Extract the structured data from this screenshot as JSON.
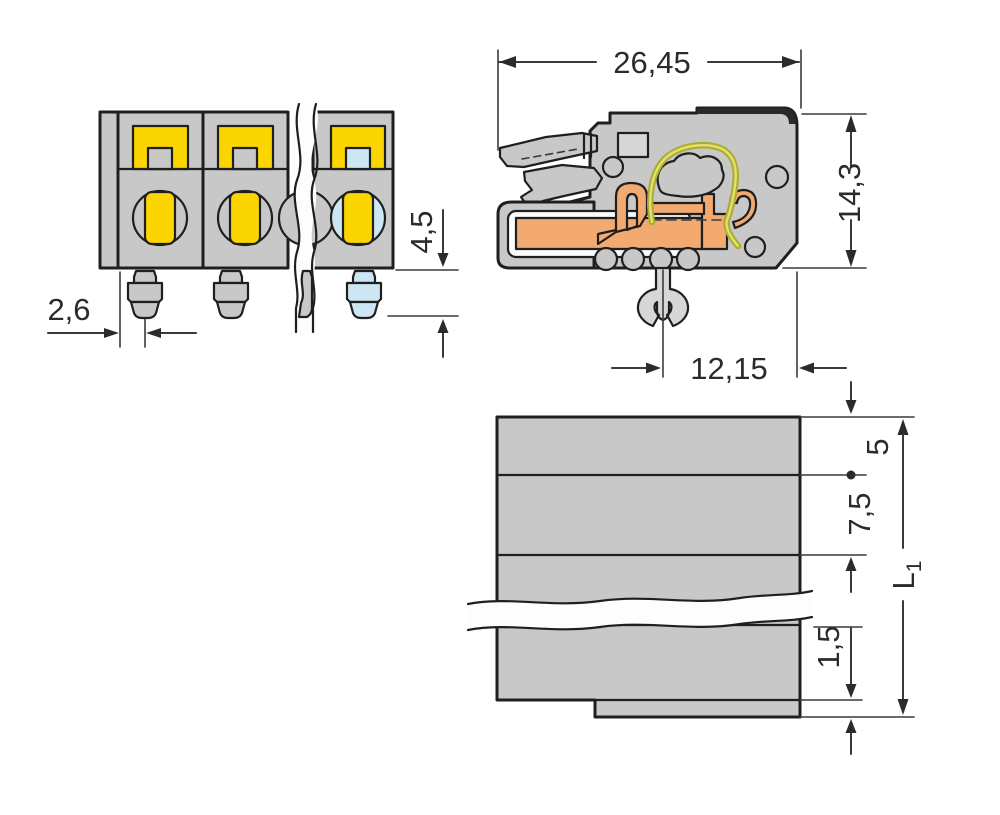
{
  "drawing": {
    "title": "terminal-block-connector-dimensional-drawing",
    "views": {
      "front": {
        "name": "front-view"
      },
      "side": {
        "name": "side-cross-section-view"
      },
      "bottom": {
        "name": "bottom-view"
      }
    },
    "dimensions": {
      "pin_edge_offset": "2,6",
      "pin_length": "4,5",
      "connector_depth": "26,45",
      "connector_height": "14,3",
      "foot_to_rear": "12,15",
      "first_pole_offset": "5",
      "pole_pitch": "7,5",
      "end_offset": "1,5",
      "total_length_symbol": "L",
      "total_length_subscript": "1"
    }
  },
  "colors": {
    "bg": "#ffffff",
    "line": "#1f1f1f",
    "dim_line": "#3a3a3a",
    "dim_text": "#2b2b2b",
    "body_gray": "#c8c8c8",
    "body_gray_light": "#d7d7d7",
    "body_dark": "#2a2a2a",
    "highlight_blue": "#cde6f3",
    "accent_yellow": "#fbd500",
    "copper_orange": "#f3aa70",
    "spring_green": "#a9ad35",
    "spring_yellow": "#e4e06a",
    "cavity_white": "#fdfdfd"
  }
}
